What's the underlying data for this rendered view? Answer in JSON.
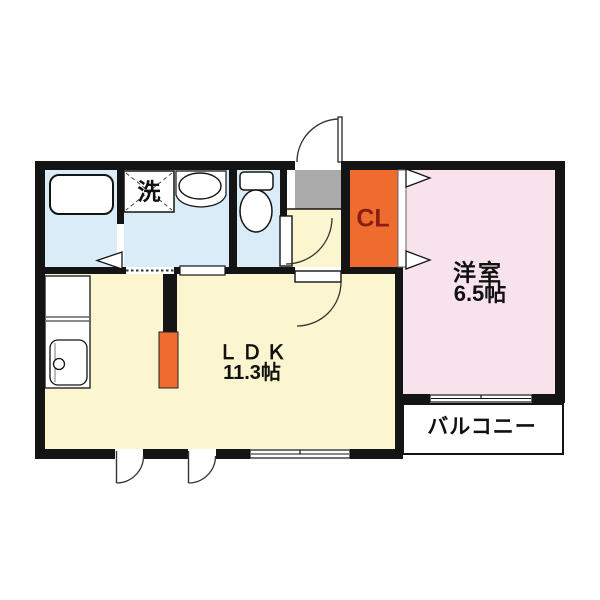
{
  "plan": {
    "type": "japanese-apartment-floorplan",
    "rooms": {
      "ldk": {
        "name": "ＬＤＫ",
        "area": "11.3帖"
      },
      "western": {
        "name": "洋室",
        "area": "6.5帖"
      },
      "closet": {
        "name": "CL"
      },
      "laundry": {
        "name": "洗"
      },
      "balcony": {
        "name": "バルコニー"
      }
    },
    "colors": {
      "wall": "#141414",
      "wet_rooms": "#d9ecf7",
      "ldk_floor": "#fbf6d0",
      "western_room_floor": "#f8e3ed",
      "closet_fill": "#ee6c2e",
      "entrance_fill": "#aaaaaa",
      "closet_label_text": "#8b1e10",
      "background": "#ffffff"
    }
  }
}
